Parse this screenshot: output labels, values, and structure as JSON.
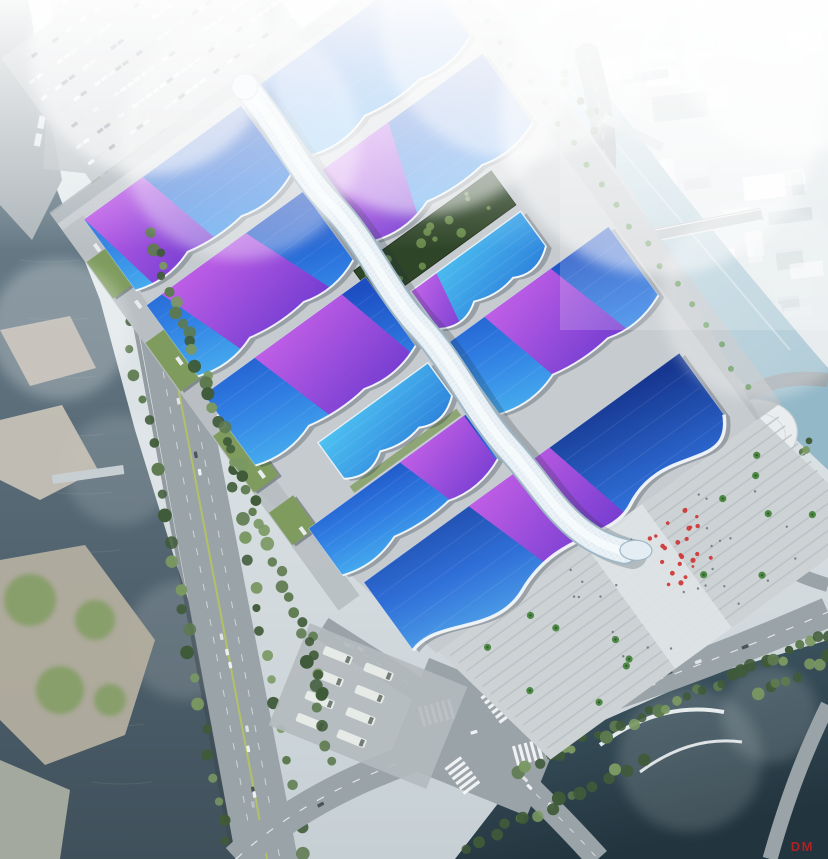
{
  "scene": {
    "description": "Aerial architectural rendering of a large exhibition and convention center with blue wave roofs, purple ribbon accents and a white serpentine central corridor, surrounded by rivers, boulevards and a hazy city",
    "watermark": "DM"
  },
  "palette": {
    "sky": "#eef3f4",
    "base": "#c6cfd4",
    "waterDarkA": "#45606c",
    "waterDarkB": "#22343e",
    "waterMidA": "#6a7e8a",
    "waterMidB": "#3f505b",
    "waterLightA": "#cfe2ea",
    "waterLightB": "#93b8c8",
    "road": "#9aa3a8",
    "roadLight": "#aeb6ba",
    "marking": "#eef2f4",
    "median": "#b5c45c",
    "apron": "#c6cbcf",
    "apron2": "#c0c6ca",
    "yard": "#b4babe",
    "treeDark": "#3f5a38",
    "tree": "#5d7a4f",
    "treeLight": "#7a9862",
    "palm": "#4e8a46",
    "grassRoof": "#7f9c5e",
    "courtyard": "#2f4528",
    "courtTree": "#6e8f4e",
    "roofDeep": "#1d4ec2",
    "roofBlue": "#2f7ce2",
    "roofAzure": "#45aaee",
    "roofCyanA": "#4fc2f2",
    "roofCyanB": "#2f86dd",
    "navyA": "#16368f",
    "navyB": "#2f6fd8",
    "navyC": "#55aaec",
    "ribbonA": "#c95fe8",
    "ribbonB": "#7a3ad0",
    "spineBase": "#e3edf3",
    "spineEdge": "#9fb6c4",
    "spineHi": "#f7fbfd",
    "spineShadow": "#22333c",
    "cityBlock": "#e4eaec",
    "cityShadow": "#c2ccd1",
    "carWhite": "#eef1f3",
    "carGrey": "#b8bfc4",
    "carDark": "#4a545c",
    "people": "#d03a3a",
    "watermark": "#c81f1f"
  },
  "complex": {
    "origin": [
      250,
      94
    ],
    "angle": -36,
    "halls": [
      {
        "id": "R1",
        "x": 14,
        "y": -2,
        "w": 198,
        "h": 92,
        "tone": "blue",
        "wave": 7,
        "ribbon": null
      },
      {
        "id": "L1",
        "x": -208,
        "y": 4,
        "w": 194,
        "h": 92,
        "tone": "blue",
        "wave": 7,
        "ribbon": {
          "t0": -208,
          "t1": -136,
          "b0": -186,
          "b1": -108
        }
      },
      {
        "id": "R2",
        "x": 14,
        "y": 104,
        "w": 198,
        "h": 92,
        "tone": "blue",
        "wave": 7,
        "ribbon": {
          "t0": 14,
          "t1": 96,
          "b0": 14,
          "b1": 58
        }
      },
      {
        "id": "L2",
        "x": -208,
        "y": 110,
        "w": 194,
        "h": 92,
        "tone": "blue",
        "wave": 7,
        "ribbon": {
          "t0": -190,
          "t1": -86,
          "b0": -150,
          "b1": -42
        }
      },
      {
        "id": "L3",
        "x": -214,
        "y": 216,
        "w": 200,
        "h": 92,
        "tone": "blue",
        "wave": 7,
        "ribbon": {
          "t0": -152,
          "t1": -44,
          "b0": -118,
          "b1": -16
        }
      },
      {
        "id": "R3s",
        "x": 14,
        "y": 254,
        "w": 136,
        "h": 52,
        "tone": "cyan",
        "wave": 9,
        "ribbon": {
          "t0": 14,
          "t1": 46,
          "b0": 14,
          "b1": 32
        }
      },
      {
        "id": "R4",
        "x": 14,
        "y": 318,
        "w": 198,
        "h": 92,
        "tone": "blue",
        "wave": 7,
        "ribbon": {
          "t0": 58,
          "t1": 140,
          "b0": 86,
          "b1": 172
        }
      },
      {
        "id": "L4s",
        "x": -150,
        "y": 322,
        "w": 136,
        "h": 50,
        "tone": "cyan",
        "wave": 9,
        "ribbon": null
      },
      {
        "id": "L5",
        "x": -208,
        "y": 386,
        "w": 194,
        "h": 62,
        "tone": "blue",
        "wave": 7,
        "ribbon": {
          "t0": -96,
          "t1": -16,
          "b0": -70,
          "b1": -16
        }
      },
      {
        "id": "GRAND",
        "x": -195,
        "y": 462,
        "w": 390,
        "h": 100,
        "tone": "navy",
        "wave": 18,
        "grand": true,
        "ribbon": {
          "t0": -66,
          "t1": 34,
          "b0": -28,
          "b1": 62
        }
      }
    ],
    "greens": [
      {
        "x": -20,
        "y": 204,
        "w": 170,
        "h": 42
      },
      {
        "x": -150,
        "y": 378,
        "w": 132,
        "h": 0
      }
    ],
    "parking": {
      "rows": 7,
      "perRow": 30
    },
    "plaza": {
      "red_people": 26,
      "grey_people": 30,
      "palms": 16
    }
  }
}
